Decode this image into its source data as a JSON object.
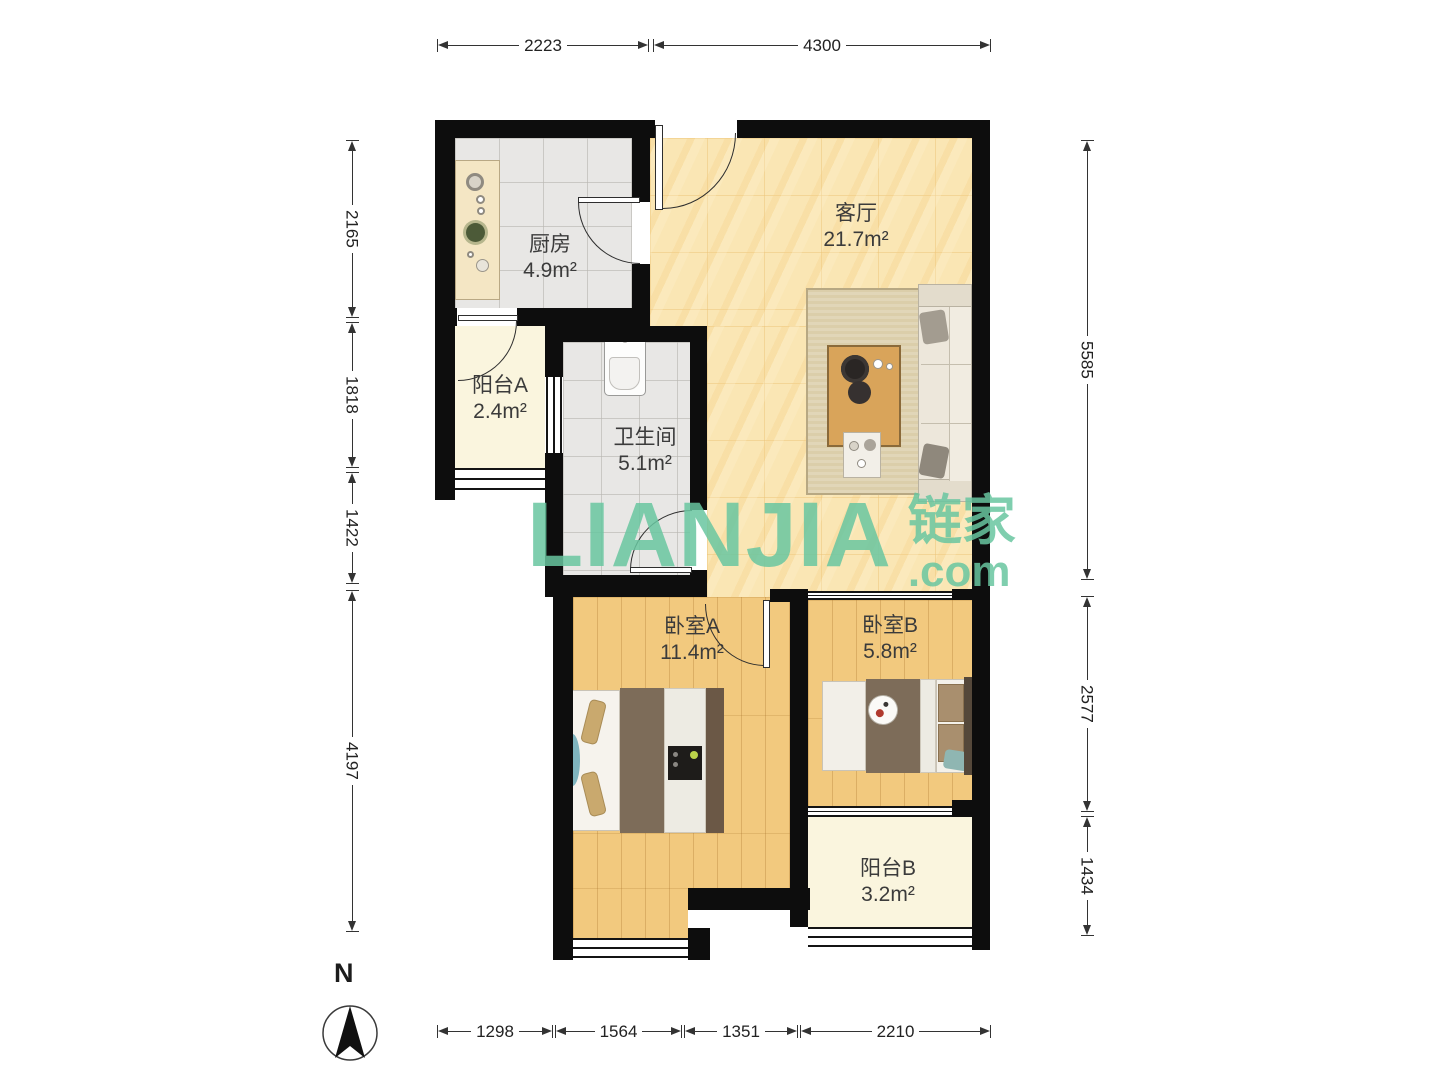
{
  "floorplan": {
    "rooms": [
      {
        "name": "厨房",
        "area": "4.9m²"
      },
      {
        "name": "客厅",
        "area": "21.7m²"
      },
      {
        "name": "阳台A",
        "area": "2.4m²"
      },
      {
        "name": "卫生间",
        "area": "5.1m²"
      },
      {
        "name": "卧室A",
        "area": "11.4m²"
      },
      {
        "name": "卧室B",
        "area": "5.8m²"
      },
      {
        "name": "阳台B",
        "area": "3.2m²"
      }
    ],
    "dimensions_mm": {
      "top": [
        "2223",
        "4300"
      ],
      "left": [
        "2165",
        "1818",
        "1422",
        "4197"
      ],
      "right": [
        "5585",
        "2577",
        "1434"
      ],
      "bottom": [
        "1298",
        "1564",
        "1351",
        "2210"
      ]
    },
    "compass": {
      "label": "N"
    },
    "watermark": {
      "latin": "LIANJIA",
      "cn": "链家",
      "tld": ".com"
    },
    "colors": {
      "wall": "#0d0d0d",
      "living_floor": "#fae6b4",
      "wood_floor": "#f2c97e",
      "tile_floor": "#e8e7e5",
      "balcony_floor": "#faf5de",
      "watermark_green": "#68c6a0"
    }
  }
}
